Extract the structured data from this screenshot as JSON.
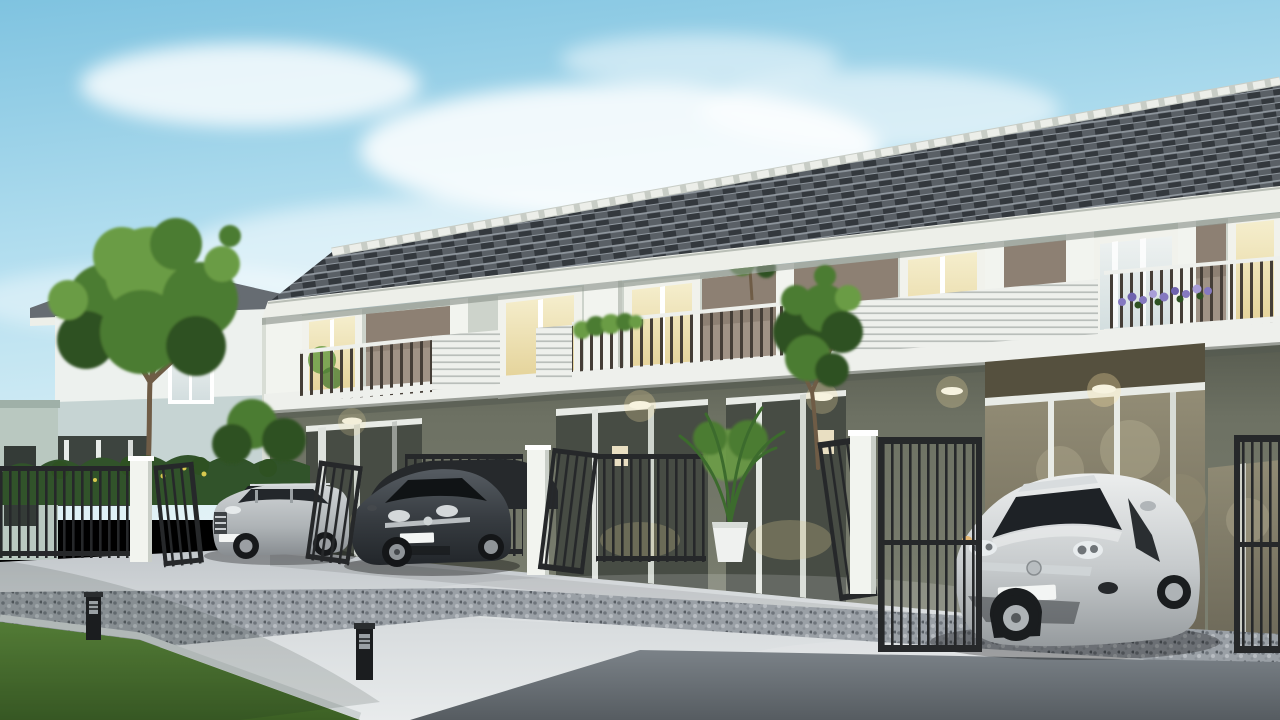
{
  "scene": {
    "type": "architectural-render",
    "description": "Row of modern two-story townhouses with gray tiled roof, taupe and white facade, balconies, ground-floor carports behind dark metal gates, three parked cars on a light concrete driveway under a blue sky with soft clouds",
    "objects": [
      "blue sky with soft clouds",
      "two-story townhouse row with gray tile roof and white ridge caps",
      "white window bays with warm interior light",
      "taupe wall panels",
      "balconies with dark railings and white slat panels",
      "balcony plants, small balcony tree and purple flower box",
      "ground-floor carports with glass doors and round ceiling lights",
      "dark metal fences and open gates with white pillars",
      "white two-story house in left background",
      "large green tree on the left",
      "clipped hedge with yellow flowers",
      "potted palm near an entrance",
      "light concrete driveway",
      "gravel strip with two black bollard lights",
      "green lawn in bottom-left corner",
      "dark walkway across the foreground"
    ],
    "cars": [
      {
        "position": "left",
        "type": "suv",
        "color": "#b3b8bb"
      },
      {
        "position": "center",
        "type": "hatchback",
        "color": "#383d42"
      },
      {
        "position": "right",
        "type": "hatchback",
        "color": "#c6cacc"
      }
    ],
    "townhouse": {
      "floors": 2,
      "visible_unit_bays": 5,
      "roof": "gray concrete tiles with pale ridge caps"
    }
  },
  "palette": {
    "sky_top": "#7fc3e0",
    "sky_mid": "#b6e0f0",
    "sky_low": "#e4f3f7",
    "cloud": "#ffffff",
    "roof_tile": "#5a6066",
    "roof_tile_dark": "#33383d",
    "roof_tile_light": "#9ba3aa",
    "fascia": "#edefe9",
    "wall_light": "#cdd3cb",
    "wall_bay": "#f1f2ec",
    "taupe": "#a09386",
    "taupe_dark": "#8d8073",
    "olive": "#6d7163",
    "olive_dark": "#50544a",
    "trim_white": "#eef0ec",
    "rail_dark": "#453e37",
    "fence_dark": "#26282a",
    "pillar_white": "#f2f4ef",
    "glass_dark": "#474c44",
    "glass_refl": "#837e6b",
    "concrete": "#c6cbce",
    "concrete_light": "#e8ebec",
    "gravel_base": "#9aa0a6",
    "road": "#646b71",
    "grass": "#4e7a31",
    "hedge": "#31532a",
    "leaf": "#4c7c33",
    "leaf_light": "#6b9c45",
    "leaf_dark": "#2e5122",
    "trunk": "#6f5c46",
    "suv_silver": "#b3b8bb",
    "car_dark": "#383d42",
    "car_silver": "#c6cacc",
    "flower_purple": "#8579c0",
    "flower_yellow": "#d9c94f",
    "glow_warm": "#ffe9a8",
    "pot_white": "#eff1ef",
    "plate_white": "#f3f5f4"
  }
}
